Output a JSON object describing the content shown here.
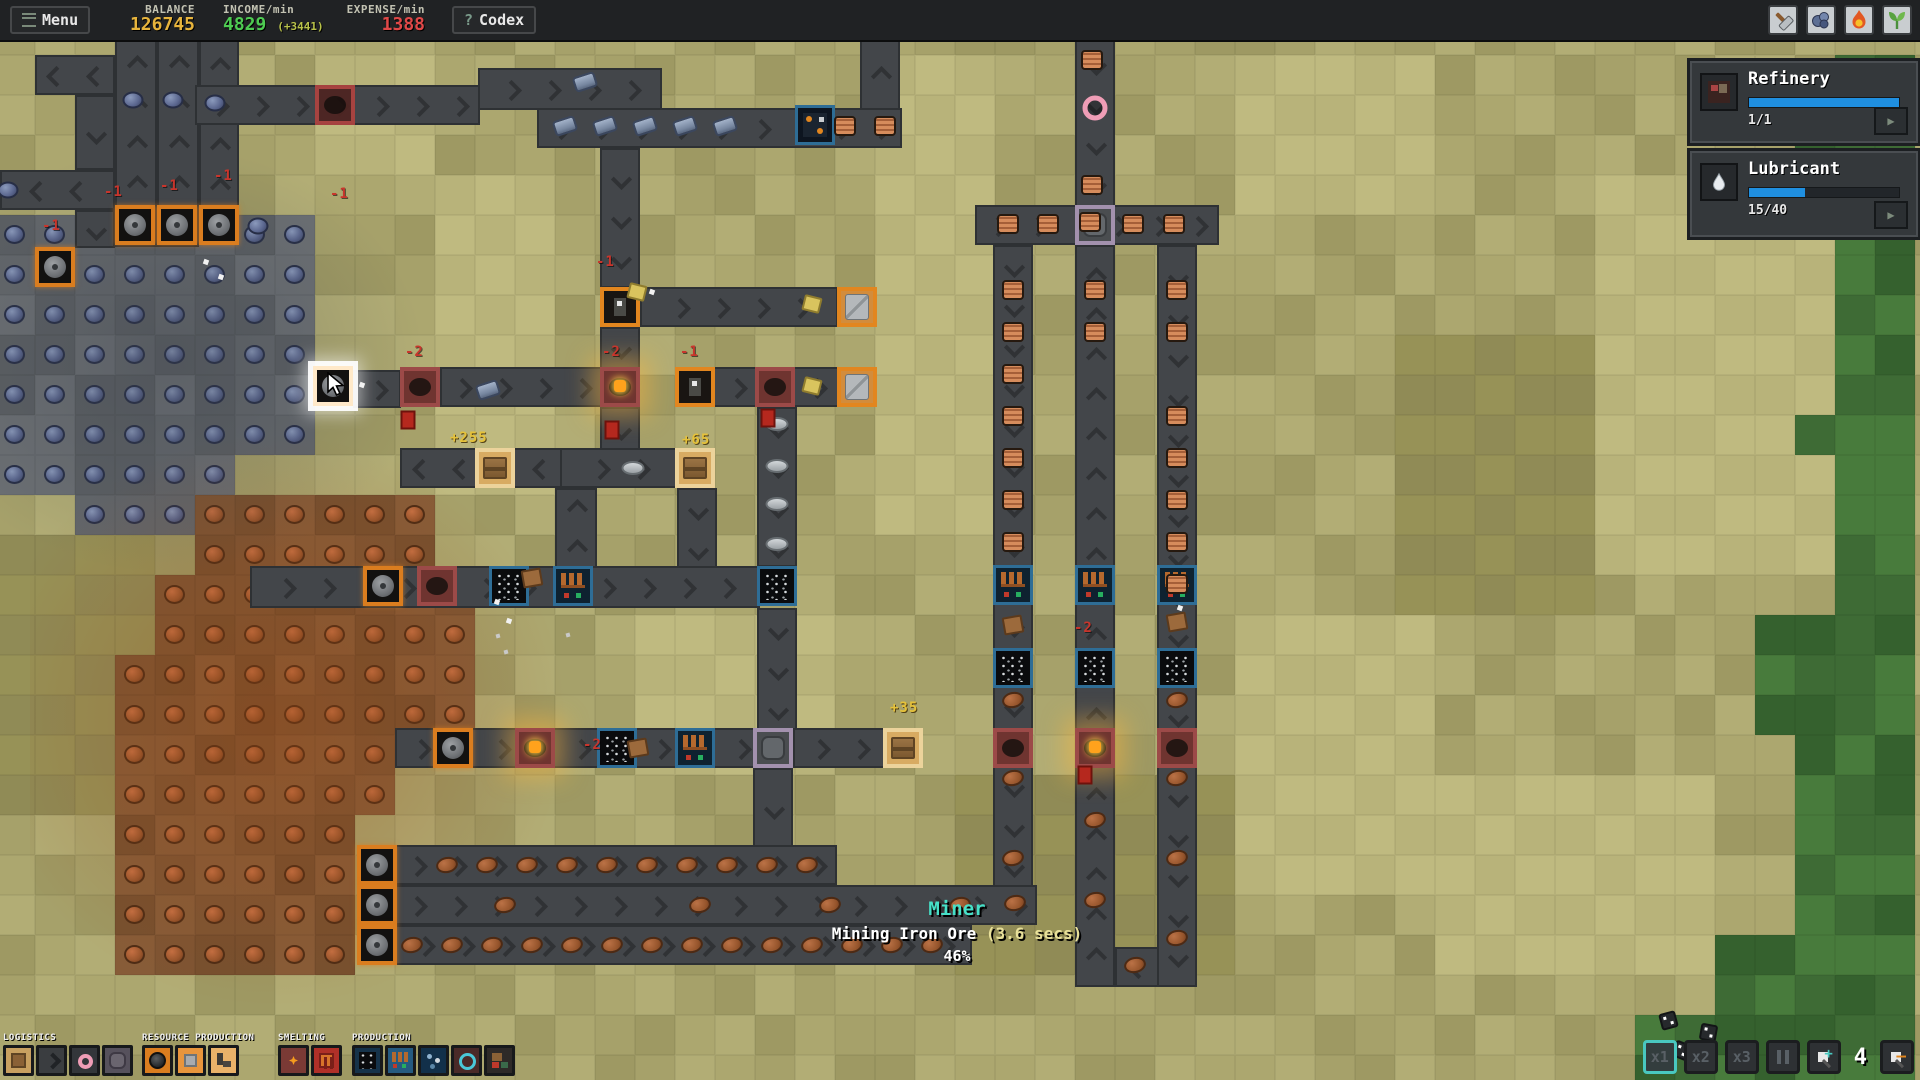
{
  "top_bar": {
    "menu_label": "Menu",
    "balance_label": "BALANCE",
    "balance_value": "126745",
    "income_label": "INCOME/min",
    "income_value": "4829",
    "income_delta": "(+3441)",
    "expense_label": "EXPENSE/min",
    "expense_value": "1388",
    "codex_q": "?",
    "codex_label": "Codex",
    "icons": [
      "hammer-icon",
      "ore-icon",
      "flame-icon",
      "sprout-icon"
    ]
  },
  "side_panel": {
    "cards": [
      {
        "title": "Refinery",
        "count": "1/1",
        "progress_pct": 100,
        "icon": "refinery-icon"
      },
      {
        "title": "Lubricant",
        "count": "15/40",
        "progress_pct": 37.5,
        "icon": "droplet-icon"
      }
    ]
  },
  "tooltip": {
    "title": "Miner",
    "line": "Mining Iron Ore ",
    "time": "(3.6 secs)",
    "percent": "46%"
  },
  "toolbar": {
    "groups": [
      {
        "label": "LOGISTICS",
        "x": 3,
        "buttons": [
          "storage",
          "conveyor",
          "tunnel",
          "pad"
        ]
      },
      {
        "label": "RESOURCE PRODUCTION",
        "x": 142,
        "buttons": [
          "miner",
          "platem",
          "extract"
        ]
      },
      {
        "label": "SMELTING",
        "x": 278,
        "buttons": [
          "furn1",
          "furn2"
        ]
      },
      {
        "label": "PRODUCTION",
        "x": 352,
        "buttons": [
          "prod1",
          "prod2",
          "prod3",
          "refinery",
          "factory"
        ]
      }
    ]
  },
  "controls": {
    "speeds": [
      "x1",
      "x2",
      "x3"
    ],
    "selected_speed": "x1",
    "counter": "4"
  },
  "colors": {
    "accent_blue": "#1f8fe0",
    "balance_gold": "#e7b43c",
    "income_green": "#4ecb52",
    "expense_red": "#e04848",
    "tooltip_teal": "#46e0c8",
    "speed_sel": "#49c8c0"
  },
  "map": {
    "tile": 40,
    "ox": -5,
    "oy": 15,
    "shades": {
      "olive": [
        "#a6a16a",
        "#aca76f",
        "#b2ad75",
        "#9e9963"
      ],
      "light": [
        "#b8b37a",
        "#bfba80"
      ],
      "dark": [
        "#979257",
        "#908b56"
      ],
      "green": [
        "#3e6b35",
        "#35612e",
        "#487b3c"
      ],
      "iron": [
        "#63676b",
        "#5b5f63",
        "#6b6f73"
      ],
      "copper": [
        "#7e5533",
        "#77502f",
        "#875c38"
      ]
    },
    "green_rects": [
      [
        1845,
        40,
        75,
        1040
      ],
      [
        1795,
        740,
        125,
        340
      ],
      [
        1725,
        955,
        195,
        125
      ],
      [
        1655,
        1008,
        265,
        72
      ],
      [
        1800,
        415,
        45,
        45
      ],
      [
        1800,
        135,
        45,
        45
      ],
      [
        1760,
        600,
        85,
        140
      ]
    ],
    "light_rects": [
      [
        860,
        40,
        150,
        480
      ],
      [
        430,
        170,
        120,
        330
      ],
      [
        1250,
        40,
        180,
        170
      ],
      [
        1600,
        180,
        240,
        380
      ],
      [
        620,
        620,
        200,
        160
      ],
      [
        1250,
        600,
        200,
        300
      ],
      [
        300,
        40,
        130,
        130
      ],
      [
        1450,
        760,
        260,
        200
      ]
    ],
    "dark_rects": [
      [
        0,
        530,
        140,
        300
      ],
      [
        950,
        760,
        300,
        220
      ],
      [
        1380,
        340,
        220,
        260
      ],
      [
        60,
        40,
        120,
        120
      ]
    ],
    "iron_rects": [
      [
        0,
        200,
        320,
        248
      ],
      [
        0,
        448,
        242,
        55
      ],
      [
        95,
        490,
        82,
        45
      ]
    ],
    "copper_rects": [
      [
        180,
        495,
        260,
        85
      ],
      [
        140,
        580,
        345,
        80
      ],
      [
        100,
        660,
        360,
        80
      ],
      [
        100,
        740,
        285,
        80
      ],
      [
        135,
        820,
        228,
        160
      ]
    ],
    "belts": [
      [
        35,
        55,
        80,
        40,
        "left"
      ],
      [
        75,
        95,
        40,
        75,
        "down"
      ],
      [
        0,
        170,
        115,
        40,
        "left"
      ],
      [
        75,
        210,
        40,
        38,
        "down"
      ],
      [
        115,
        40,
        42,
        207,
        "up"
      ],
      [
        157,
        40,
        42,
        207,
        "up"
      ],
      [
        199,
        40,
        40,
        172,
        "up"
      ],
      [
        195,
        85,
        285,
        40,
        "right"
      ],
      [
        478,
        68,
        184,
        42,
        "right"
      ],
      [
        537,
        108,
        365,
        40,
        "right"
      ],
      [
        860,
        40,
        40,
        70,
        "up"
      ],
      [
        600,
        148,
        40,
        140,
        "down"
      ],
      [
        640,
        287,
        198,
        40,
        "right"
      ],
      [
        600,
        327,
        40,
        42,
        "down"
      ],
      [
        353,
        370,
        48,
        38,
        "right"
      ],
      [
        440,
        367,
        162,
        40,
        "right"
      ],
      [
        713,
        367,
        126,
        40,
        "right"
      ],
      [
        600,
        407,
        40,
        43,
        "down"
      ],
      [
        400,
        448,
        162,
        40,
        "left"
      ],
      [
        560,
        448,
        117,
        40,
        "right"
      ],
      [
        555,
        488,
        42,
        80,
        "up"
      ],
      [
        677,
        488,
        40,
        82,
        "down"
      ],
      [
        250,
        566,
        510,
        42,
        "right"
      ],
      [
        757,
        407,
        40,
        160,
        "down"
      ],
      [
        757,
        608,
        40,
        122,
        "down"
      ],
      [
        395,
        728,
        490,
        40,
        "right"
      ],
      [
        793,
        728,
        92,
        40,
        "right"
      ],
      [
        753,
        768,
        40,
        79,
        "down"
      ],
      [
        395,
        845,
        442,
        40,
        "right"
      ],
      [
        395,
        885,
        642,
        40,
        "right"
      ],
      [
        395,
        925,
        577,
        40,
        "right"
      ],
      [
        975,
        205,
        244,
        40,
        "right"
      ],
      [
        993,
        245,
        40,
        642,
        "down"
      ],
      [
        1075,
        40,
        40,
        167,
        "down"
      ],
      [
        1075,
        245,
        40,
        742,
        "up"
      ],
      [
        1157,
        245,
        40,
        742,
        "down"
      ],
      [
        1115,
        947,
        44,
        40,
        "left"
      ]
    ],
    "machines": [
      {
        "t": "miner",
        "x": 115,
        "y": 205
      },
      {
        "t": "miner",
        "x": 157,
        "y": 205
      },
      {
        "t": "miner",
        "x": 199,
        "y": 205
      },
      {
        "t": "miner",
        "x": 35,
        "y": 247
      },
      {
        "t": "miner",
        "x": 313,
        "y": 366,
        "hl": true
      },
      {
        "t": "furnace",
        "x": 315,
        "y": 85,
        "tint": true
      },
      {
        "t": "extractor",
        "x": 600,
        "y": 287
      },
      {
        "t": "platem",
        "x": 837,
        "y": 287
      },
      {
        "t": "furnace",
        "x": 400,
        "y": 367
      },
      {
        "t": "furnace",
        "x": 600,
        "y": 367,
        "glow": true
      },
      {
        "t": "extractor",
        "x": 675,
        "y": 367
      },
      {
        "t": "furnace",
        "x": 755,
        "y": 367
      },
      {
        "t": "platem",
        "x": 837,
        "y": 367
      },
      {
        "t": "crate",
        "x": 475,
        "y": 448
      },
      {
        "t": "crate",
        "x": 675,
        "y": 448
      },
      {
        "t": "miner",
        "x": 363,
        "y": 566
      },
      {
        "t": "furnace",
        "x": 417,
        "y": 566
      },
      {
        "t": "crusher",
        "x": 489,
        "y": 566
      },
      {
        "t": "assembler",
        "x": 553,
        "y": 566
      },
      {
        "t": "crusher",
        "x": 757,
        "y": 566
      },
      {
        "t": "miner",
        "x": 433,
        "y": 728
      },
      {
        "t": "furnace",
        "x": 515,
        "y": 728,
        "glow": true
      },
      {
        "t": "crusher",
        "x": 597,
        "y": 728
      },
      {
        "t": "assembler",
        "x": 675,
        "y": 728
      },
      {
        "t": "splitter",
        "x": 753,
        "y": 728
      },
      {
        "t": "crate",
        "x": 883,
        "y": 728
      },
      {
        "t": "miner",
        "x": 357,
        "y": 845
      },
      {
        "t": "miner",
        "x": 357,
        "y": 885
      },
      {
        "t": "miner",
        "x": 357,
        "y": 925
      },
      {
        "t": "splitter",
        "x": 1075,
        "y": 205
      },
      {
        "t": "assembler",
        "x": 993,
        "y": 565
      },
      {
        "t": "assembler",
        "x": 1075,
        "y": 565
      },
      {
        "t": "assembler",
        "x": 1157,
        "y": 565
      },
      {
        "t": "crusher",
        "x": 993,
        "y": 648
      },
      {
        "t": "crusher",
        "x": 1075,
        "y": 648
      },
      {
        "t": "crusher",
        "x": 1157,
        "y": 648
      },
      {
        "t": "furnace",
        "x": 993,
        "y": 728
      },
      {
        "t": "furnace",
        "x": 1075,
        "y": 728,
        "glow": true
      },
      {
        "t": "furnace",
        "x": 1157,
        "y": 728
      },
      {
        "t": "wirem",
        "x": 795,
        "y": 105
      }
    ],
    "items": {
      "blue_dot": [
        [
          133,
          100
        ],
        [
          173,
          100
        ],
        [
          215,
          103
        ],
        [
          8,
          190
        ],
        [
          258,
          226
        ]
      ],
      "iron_cyl": [
        [
          585,
          82
        ],
        [
          565,
          126
        ],
        [
          605,
          126
        ],
        [
          645,
          126
        ],
        [
          685,
          126
        ],
        [
          725,
          126
        ],
        [
          488,
          390
        ]
      ],
      "coil": [
        [
          845,
          126
        ],
        [
          885,
          126
        ],
        [
          1092,
          60
        ],
        [
          1092,
          185
        ],
        [
          1008,
          224
        ],
        [
          1048,
          224
        ],
        [
          1090,
          222
        ],
        [
          1133,
          224
        ],
        [
          1174,
          224
        ],
        [
          1013,
          290
        ],
        [
          1013,
          332
        ],
        [
          1013,
          374
        ],
        [
          1013,
          416
        ],
        [
          1013,
          458
        ],
        [
          1013,
          500
        ],
        [
          1013,
          542
        ],
        [
          1177,
          290
        ],
        [
          1177,
          332
        ],
        [
          1177,
          416
        ],
        [
          1177,
          458
        ],
        [
          1177,
          500
        ],
        [
          1177,
          542
        ],
        [
          1177,
          584
        ],
        [
          1095,
          290
        ],
        [
          1095,
          332
        ]
      ],
      "pink_ring": [
        [
          1095,
          108
        ]
      ],
      "plate_item": [
        [
          777,
          424
        ],
        [
          777,
          466
        ],
        [
          777,
          504
        ],
        [
          777,
          544
        ],
        [
          633,
          468
        ]
      ],
      "chunk": [
        [
          637,
          292
        ],
        [
          812,
          304
        ],
        [
          812,
          386
        ]
      ],
      "red_item": [
        [
          612,
          430
        ],
        [
          408,
          420
        ],
        [
          768,
          418
        ],
        [
          1085,
          775
        ]
      ],
      "brown_sq": [
        [
          638,
          748
        ],
        [
          532,
          578
        ],
        [
          1013,
          625
        ],
        [
          1177,
          622
        ]
      ],
      "copper_oval": [
        [
          447,
          865
        ],
        [
          487,
          865
        ],
        [
          527,
          865
        ],
        [
          567,
          865
        ],
        [
          607,
          865
        ],
        [
          647,
          865
        ],
        [
          687,
          865
        ],
        [
          727,
          865
        ],
        [
          767,
          865
        ],
        [
          807,
          865
        ],
        [
          505,
          905
        ],
        [
          700,
          905
        ],
        [
          830,
          905
        ],
        [
          960,
          905
        ],
        [
          1015,
          903
        ],
        [
          412,
          945
        ],
        [
          452,
          945
        ],
        [
          492,
          945
        ],
        [
          532,
          945
        ],
        [
          572,
          945
        ],
        [
          612,
          945
        ],
        [
          652,
          945
        ],
        [
          692,
          945
        ],
        [
          732,
          945
        ],
        [
          772,
          945
        ],
        [
          812,
          945
        ],
        [
          852,
          945
        ],
        [
          892,
          945
        ],
        [
          932,
          945
        ],
        [
          1013,
          778
        ],
        [
          1013,
          858
        ],
        [
          1095,
          820
        ],
        [
          1095,
          900
        ],
        [
          1177,
          778
        ],
        [
          1177,
          858
        ],
        [
          1177,
          938
        ],
        [
          1135,
          965
        ],
        [
          1013,
          700
        ],
        [
          1177,
          700
        ]
      ],
      "white_p": [
        [
          652,
          292
        ],
        [
          497,
          602
        ],
        [
          509,
          621
        ],
        [
          1180,
          608
        ],
        [
          362,
          385
        ],
        [
          206,
          262
        ],
        [
          221,
          277
        ]
      ],
      "gray_p": [
        [
          498,
          636
        ],
        [
          506,
          652
        ],
        [
          568,
          635
        ]
      ]
    },
    "texts": [
      {
        "t": "-1",
        "x": 596,
        "y": 254,
        "c": "red"
      },
      {
        "t": "-1",
        "x": 680,
        "y": 344,
        "c": "red"
      },
      {
        "t": "-1",
        "x": 104,
        "y": 184,
        "c": "red"
      },
      {
        "t": "-1",
        "x": 160,
        "y": 178,
        "c": "red"
      },
      {
        "t": "-1",
        "x": 214,
        "y": 168,
        "c": "red"
      },
      {
        "t": "-1",
        "x": 42,
        "y": 218,
        "c": "red"
      },
      {
        "t": "-1",
        "x": 330,
        "y": 186,
        "c": "red"
      },
      {
        "t": "-2",
        "x": 405,
        "y": 344,
        "c": "red"
      },
      {
        "t": "-2",
        "x": 602,
        "y": 344,
        "c": "red"
      },
      {
        "t": "-2",
        "x": 583,
        "y": 737,
        "c": "red"
      },
      {
        "t": "-2",
        "x": 1074,
        "y": 620,
        "c": "red"
      },
      {
        "t": "+255",
        "x": 450,
        "y": 430,
        "c": "yellow"
      },
      {
        "t": "+65",
        "x": 682,
        "y": 432,
        "c": "yellow"
      },
      {
        "t": "+35",
        "x": 890,
        "y": 700,
        "c": "yellow"
      }
    ],
    "dice": [
      [
        1660,
        1012,
        -15
      ],
      [
        1700,
        1024,
        10
      ],
      [
        1673,
        1042,
        22
      ]
    ]
  }
}
